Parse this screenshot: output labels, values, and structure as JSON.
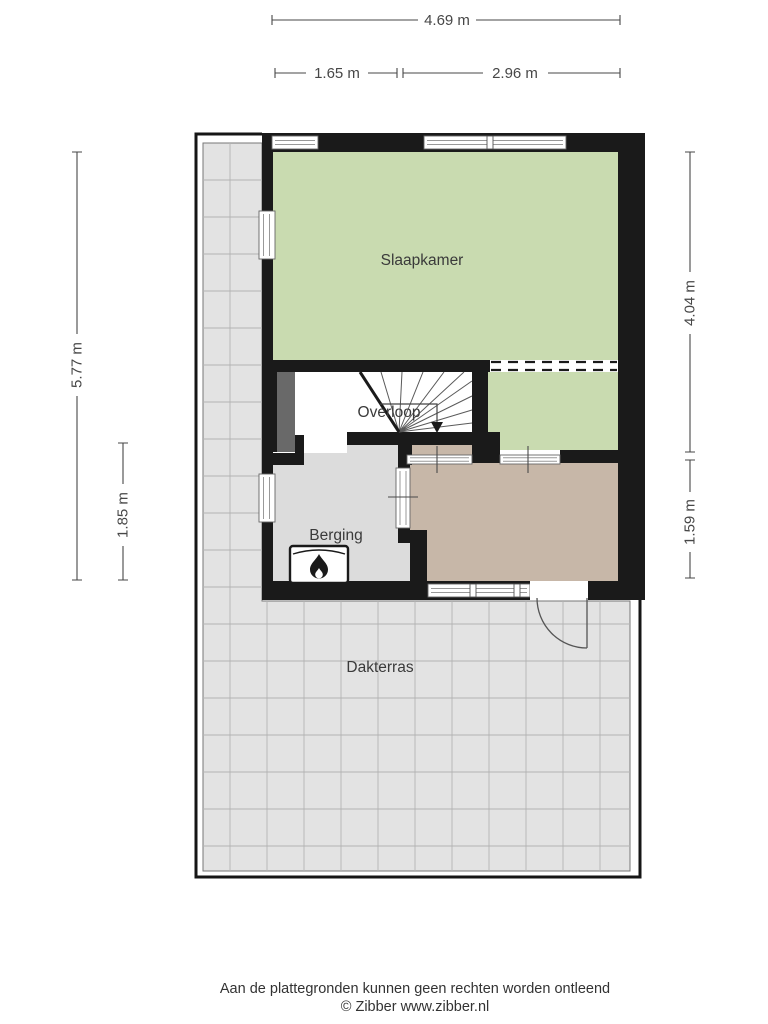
{
  "floorplan": {
    "rooms": {
      "slaapkamer": "Slaapkamer",
      "overloop": "Overloop",
      "berging": "Berging",
      "dakterras": "Dakterras"
    },
    "dimensions": {
      "top_total": "4.69 m",
      "top_segment_left": "1.65 m",
      "top_segment_right": "2.96 m",
      "left_total": "5.77 m",
      "left_segment": "1.85 m",
      "right_upper": "4.04 m",
      "right_lower": "1.59 m"
    },
    "colors": {
      "wall": "#1a1a1a",
      "bedroom": "#c9dbb0",
      "hall": "#c7b7a8",
      "storage": "#dcdcdc",
      "landing": "#ffffff",
      "terrace": "#e3e3e3",
      "terrace_grid": "#b3b3b3",
      "chimney": "#696969",
      "glazing": "#999999",
      "dimension": "#474747",
      "label": "#3a3a3a"
    },
    "icons": {
      "heater": "flame-icon"
    }
  },
  "footer": {
    "disclaimer": "Aan de plattegronden kunnen geen rechten worden ontleend",
    "credit": "© Zibber www.zibber.nl"
  }
}
